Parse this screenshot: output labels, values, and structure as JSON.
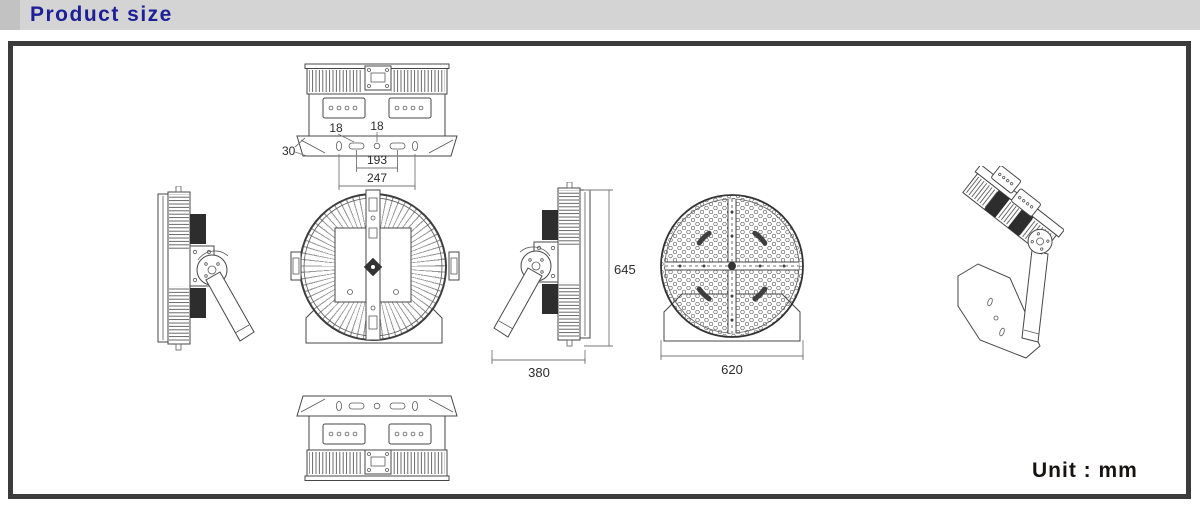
{
  "header": {
    "title": "Product size",
    "bg_color": "#d4d4d4",
    "title_color": "#1e1e96"
  },
  "frame": {
    "border_color": "#3b3b3b"
  },
  "footer": {
    "unit_label": "Unit : mm"
  },
  "dimensions": {
    "top_view": {
      "mount_hole_left": "18",
      "mount_hole_center": "18",
      "bracket_plate": "30",
      "hole_spacing": "193",
      "bracket_width": "247"
    },
    "side_view": {
      "body_depth": "380",
      "overall_height": "645"
    },
    "front_view": {
      "body_diameter": "620"
    }
  },
  "drawing": {
    "line_color": "#474747",
    "dim_text_color": "#2b2b2b",
    "views": [
      "top view",
      "side view left",
      "back view",
      "side view right",
      "front view",
      "isometric view",
      "bottom view"
    ]
  }
}
